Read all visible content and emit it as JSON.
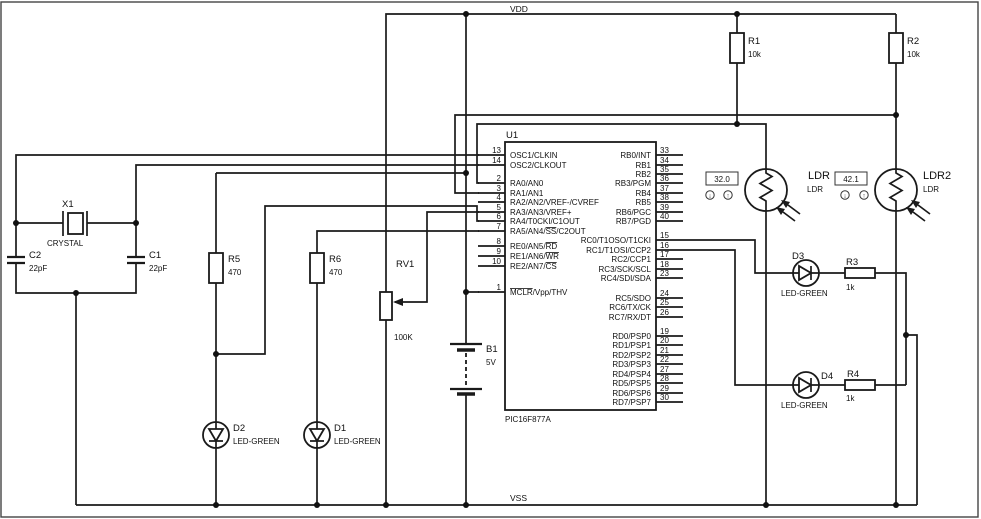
{
  "power": {
    "vdd": "VDD",
    "vss": "VSS"
  },
  "ui": {
    "down_arrow": "↓",
    "up_arrow": "↑"
  },
  "chip": {
    "ref": "U1",
    "part": "PIC16F877A",
    "left_pins": [
      {
        "num": "13",
        "pre": "OSC1/CLKIN",
        "ov": "",
        "post": ""
      },
      {
        "num": "14",
        "pre": "OSC2/CLKOUT",
        "ov": "",
        "post": ""
      },
      {
        "num": "2",
        "pre": "RA0/AN0",
        "ov": "",
        "post": ""
      },
      {
        "num": "3",
        "pre": "RA1/AN1",
        "ov": "",
        "post": ""
      },
      {
        "num": "4",
        "pre": "RA2/AN2/VREF-/CVREF",
        "ov": "",
        "post": ""
      },
      {
        "num": "5",
        "pre": "RA3/AN3/VREF+",
        "ov": "",
        "post": ""
      },
      {
        "num": "6",
        "pre": "RA4/T0CKI/C1OUT",
        "ov": "",
        "post": ""
      },
      {
        "num": "7",
        "pre": "RA5/AN4/",
        "ov": "SS",
        "post": "/C2OUT"
      },
      {
        "num": "8",
        "pre": "RE0/AN5/",
        "ov": "RD",
        "post": ""
      },
      {
        "num": "9",
        "pre": "RE1/AN6/",
        "ov": "WR",
        "post": ""
      },
      {
        "num": "10",
        "pre": "RE2/AN7/",
        "ov": "CS",
        "post": ""
      },
      {
        "num": "1",
        "pre": "",
        "ov": "MCLR",
        "post": "/Vpp/THV"
      }
    ],
    "right_pins": [
      {
        "num": "33",
        "name": "RB0/INT"
      },
      {
        "num": "34",
        "name": "RB1"
      },
      {
        "num": "35",
        "name": "RB2"
      },
      {
        "num": "36",
        "name": "RB3/PGM"
      },
      {
        "num": "37",
        "name": "RB4"
      },
      {
        "num": "38",
        "name": "RB5"
      },
      {
        "num": "39",
        "name": "RB6/PGC"
      },
      {
        "num": "40",
        "name": "RB7/PGD"
      },
      {
        "num": "15",
        "name": "RC0/T1OSO/T1CKI"
      },
      {
        "num": "16",
        "name": "RC1/T1OSI/CCP2"
      },
      {
        "num": "17",
        "name": "RC2/CCP1"
      },
      {
        "num": "18",
        "name": "RC3/SCK/SCL"
      },
      {
        "num": "23",
        "name": "RC4/SDI/SDA"
      },
      {
        "num": "24",
        "name": "RC5/SDO"
      },
      {
        "num": "25",
        "name": "RC6/TX/CK"
      },
      {
        "num": "26",
        "name": "RC7/RX/DT"
      },
      {
        "num": "19",
        "name": "RD0/PSP0"
      },
      {
        "num": "20",
        "name": "RD1/PSP1"
      },
      {
        "num": "21",
        "name": "RD2/PSP2"
      },
      {
        "num": "22",
        "name": "RD3/PSP3"
      },
      {
        "num": "27",
        "name": "RD4/PSP4"
      },
      {
        "num": "28",
        "name": "RD5/PSP5"
      },
      {
        "num": "29",
        "name": "RD6/PSP6"
      },
      {
        "num": "30",
        "name": "RD7/PSP7"
      }
    ]
  },
  "components": {
    "x1": {
      "ref": "X1",
      "value": "CRYSTAL"
    },
    "c1": {
      "ref": "C1",
      "value": "22pF"
    },
    "c2": {
      "ref": "C2",
      "value": "22pF"
    },
    "r1": {
      "ref": "R1",
      "value": "10k"
    },
    "r2": {
      "ref": "R2",
      "value": "10k"
    },
    "r3": {
      "ref": "R3",
      "value": "1k"
    },
    "r4": {
      "ref": "R4",
      "value": "1k"
    },
    "r5": {
      "ref": "R5",
      "value": "470"
    },
    "r6": {
      "ref": "R6",
      "value": "470"
    },
    "rv1": {
      "ref": "RV1",
      "value": "100K"
    },
    "b1": {
      "ref": "B1",
      "value": "5V"
    },
    "d1": {
      "ref": "D1",
      "value": "LED-GREEN"
    },
    "d2": {
      "ref": "D2",
      "value": "LED-GREEN"
    },
    "d3": {
      "ref": "D3",
      "value": "LED-GREEN"
    },
    "d4": {
      "ref": "D4",
      "value": "LED-GREEN"
    },
    "ldr1": {
      "ref": "LDR",
      "model": "LDR",
      "reading": "32.0"
    },
    "ldr2": {
      "ref": "LDR2",
      "model": "LDR",
      "reading": "42.1"
    }
  }
}
